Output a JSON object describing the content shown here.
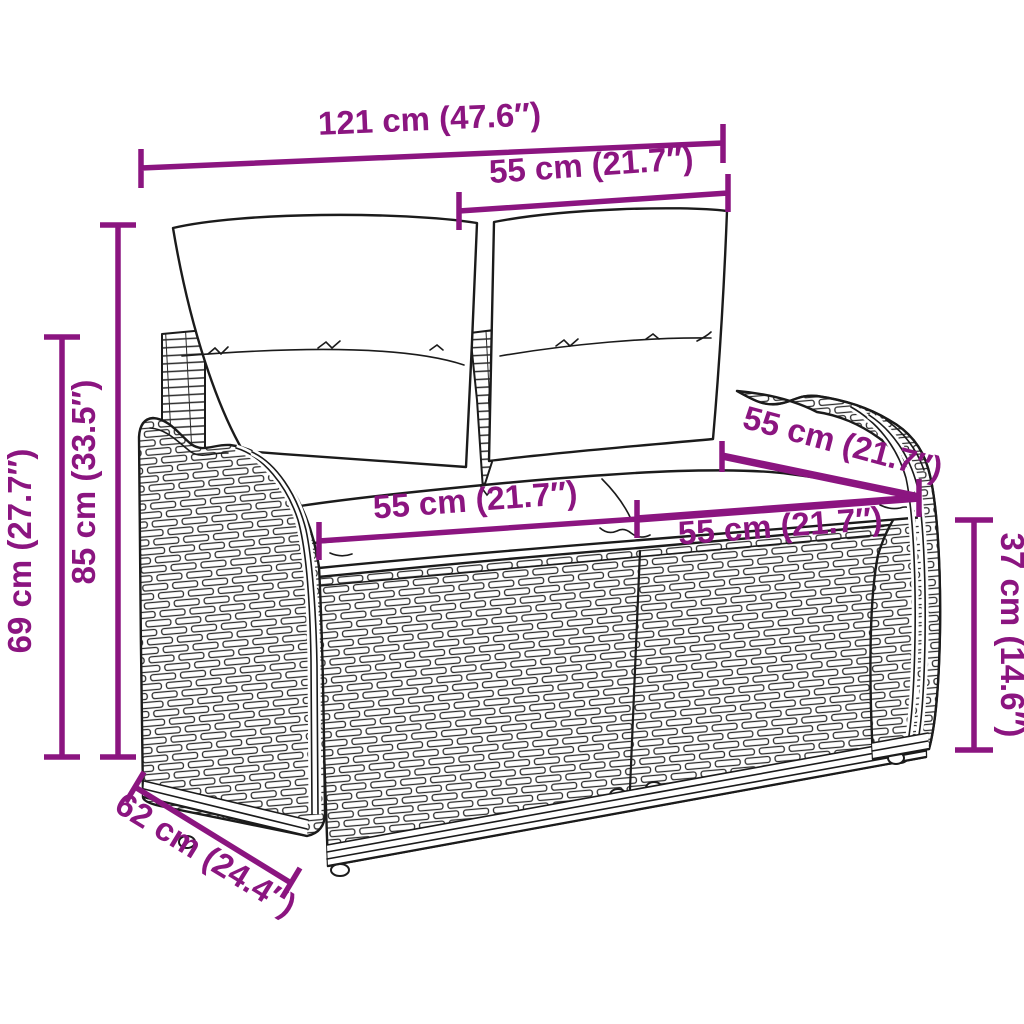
{
  "figure": {
    "kind": "product-dimension-diagram",
    "subject": "poly-rattan-garden-bench-with-cushions"
  },
  "style": {
    "accent_color": "#8B1580",
    "line_color": "#1b1b1b",
    "background": "#ffffff"
  },
  "dimensions": [
    {
      "id": "total-width",
      "label": "121 cm (47.6″)"
    },
    {
      "id": "backrest-width-top",
      "label": "55 cm (21.7″)"
    },
    {
      "id": "total-height",
      "label": "85 cm (33.5″)"
    },
    {
      "id": "armrest-height",
      "label": "69 cm (27.7″)"
    },
    {
      "id": "seat-width-left",
      "label": "55 cm (21.7″)"
    },
    {
      "id": "seat-width-right",
      "label": "55 cm (21.7″)"
    },
    {
      "id": "backrest-panel-width",
      "label": "55 cm (21.7″)"
    },
    {
      "id": "seat-height",
      "label": "37 cm (14.6″)"
    },
    {
      "id": "seat-depth",
      "label": "62 cm (24.4″)"
    }
  ]
}
